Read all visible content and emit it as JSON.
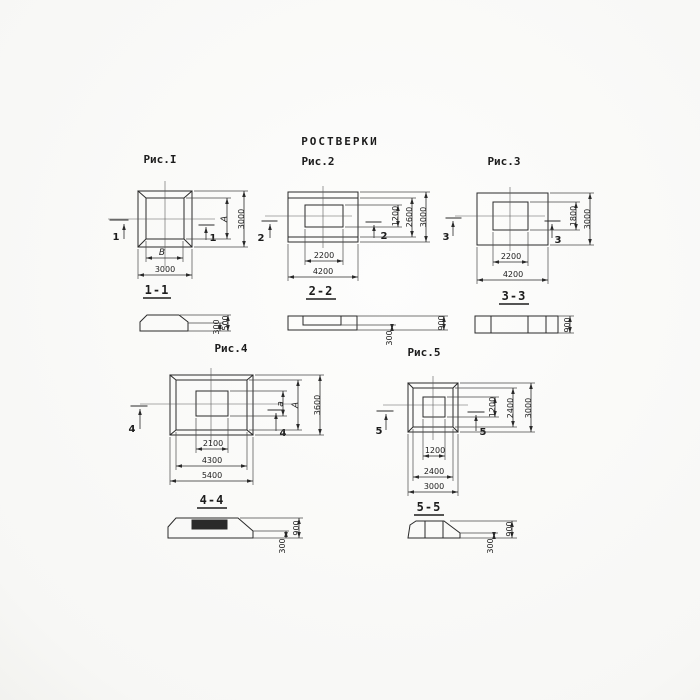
{
  "title": "РОСТВЕРКИ",
  "colors": {
    "ink": "#2a2a2a",
    "paper": "#fcfcfb"
  },
  "figures": {
    "fig1": {
      "label": "Рис.I",
      "plan": {
        "width_inner": "B",
        "width_outer": "3000",
        "height_inner": "A",
        "height_outer": "3000"
      },
      "cut_mark": "1",
      "section": {
        "label": "1-1",
        "height_total": "500",
        "height_edge": "300"
      }
    },
    "fig2": {
      "label": "Рис.2",
      "plan": {
        "width_inner": "2200",
        "width_outer": "4200",
        "height_inner": "1200",
        "height_mid": "2600",
        "height_outer": "3000"
      },
      "cut_mark": "2",
      "section": {
        "label": "2-2",
        "height_total": "900",
        "height_edge": "300"
      }
    },
    "fig3": {
      "label": "Рис.3",
      "plan": {
        "width_inner": "2200",
        "width_outer": "4200",
        "height_inner": "1800",
        "height_outer": "3000"
      },
      "cut_mark": "3",
      "section": {
        "label": "3-3",
        "height_total": "900"
      }
    },
    "fig4": {
      "label": "Рис.4",
      "plan": {
        "width_inner": "2100",
        "width_mid": "4300",
        "width_outer": "5400",
        "height_inner": "a",
        "height_mid": "A",
        "height_outer": "3600"
      },
      "cut_mark": "4",
      "section": {
        "label": "4-4",
        "height_total": "900",
        "height_edge": "300"
      }
    },
    "fig5": {
      "label": "Рис.5",
      "plan": {
        "width_inner": "1200",
        "width_mid": "2400",
        "width_outer": "3000",
        "height_inner": "1200",
        "height_mid": "2400",
        "height_outer": "3000"
      },
      "cut_mark": "5",
      "section": {
        "label": "5-5",
        "height_total": "900",
        "height_edge": "300"
      }
    }
  }
}
